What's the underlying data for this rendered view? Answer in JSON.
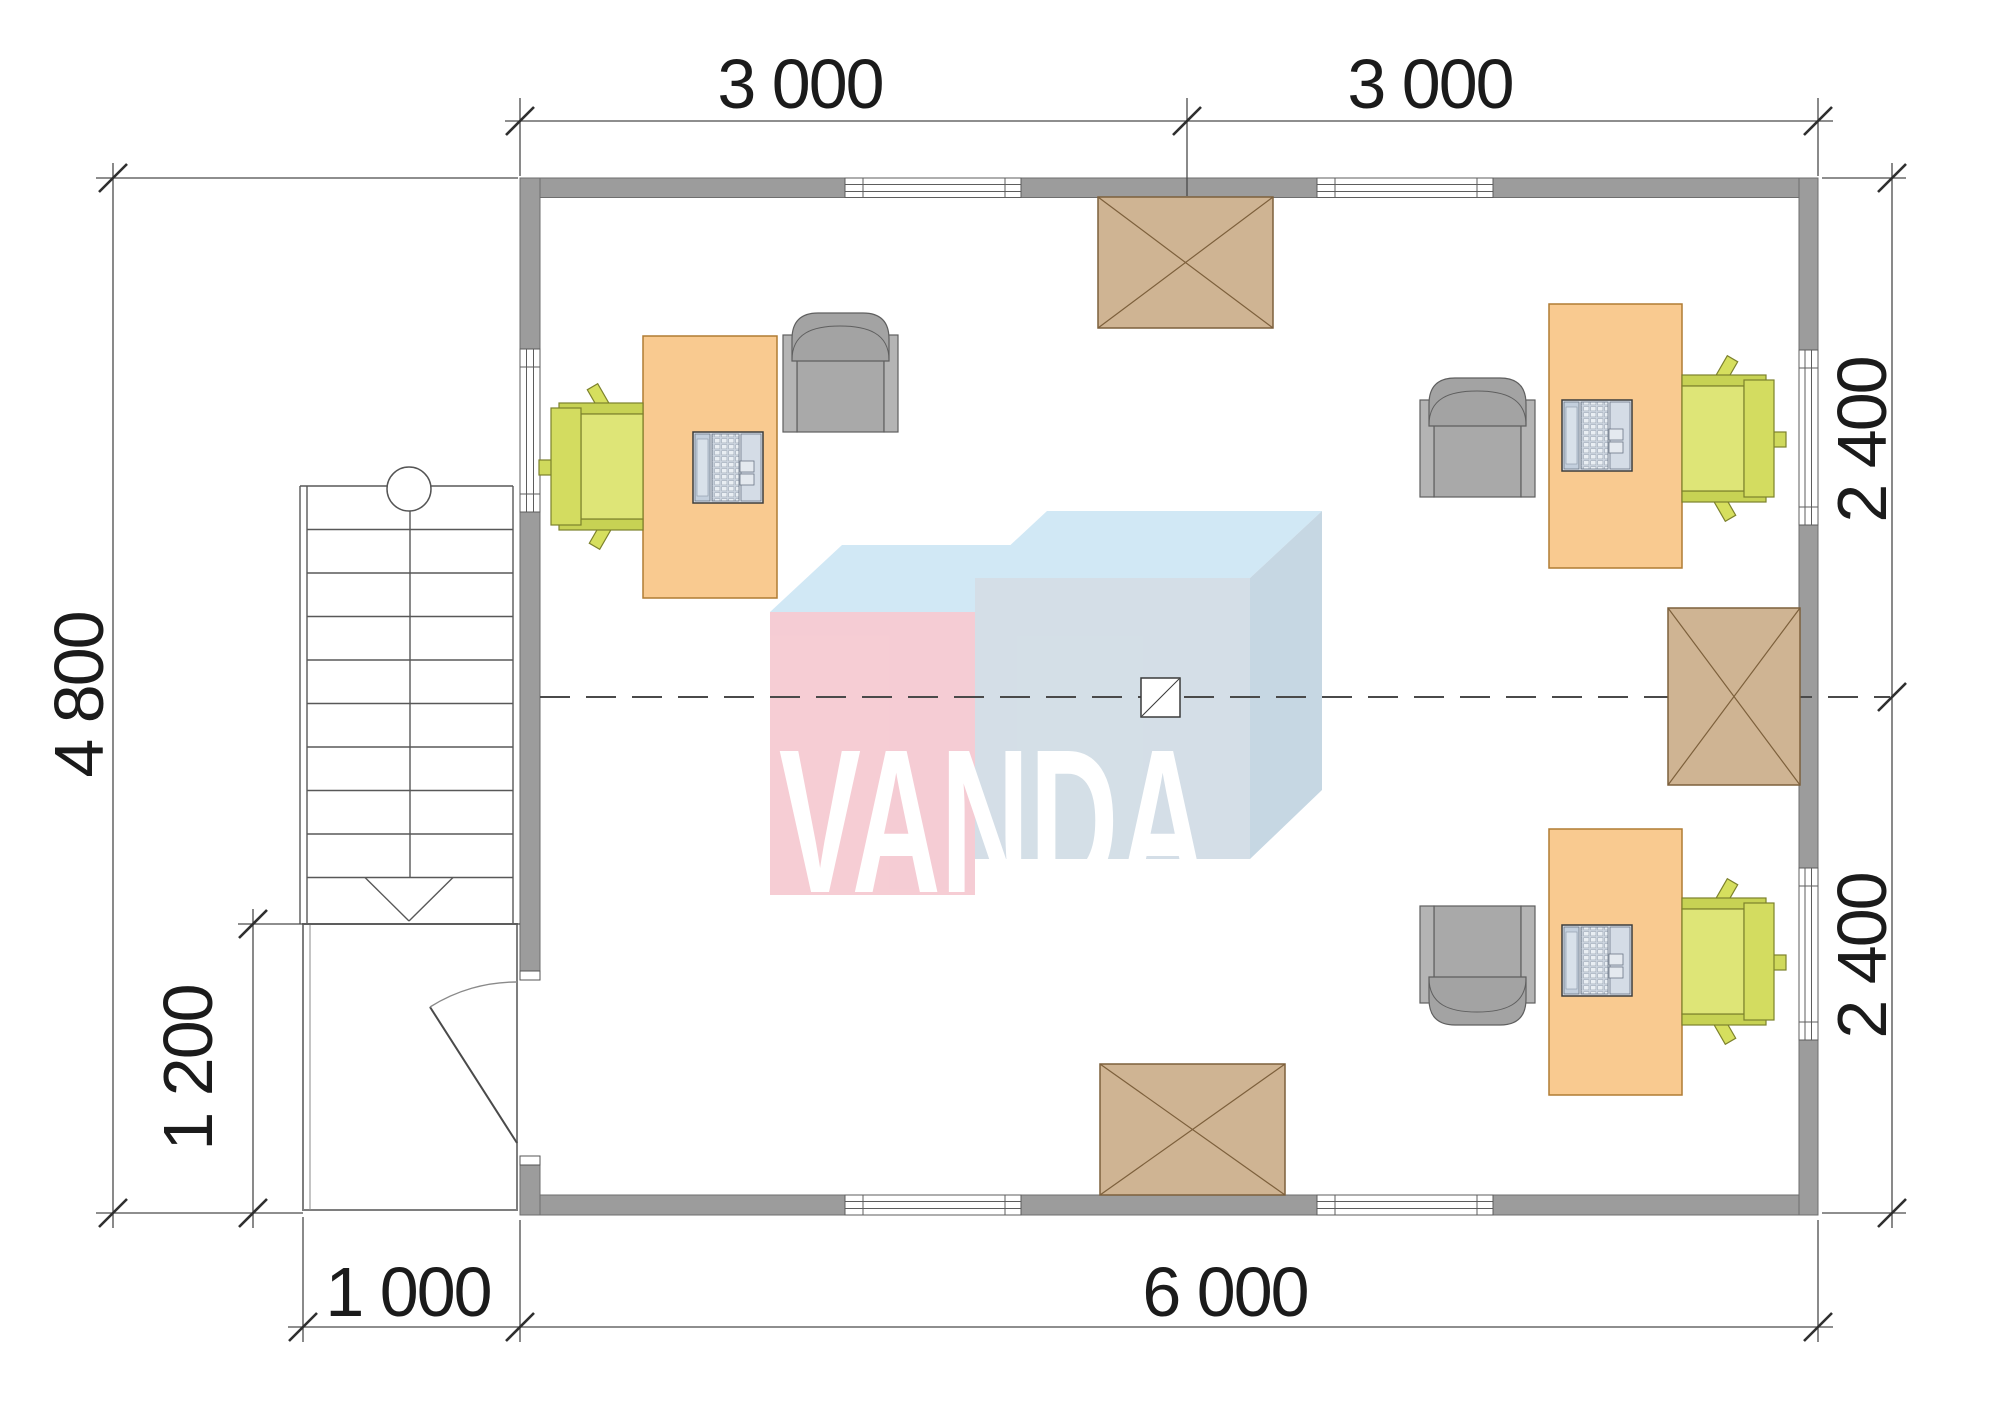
{
  "dimensions": {
    "top_left_span": "3 000",
    "top_right_span": "3 000",
    "left_height": "4 800",
    "porch_height": "1 200",
    "right_upper_span": "2 400",
    "right_lower_span": "2 400",
    "bottom_porch_span": "1 000",
    "bottom_main_span": "6 000"
  },
  "watermark": {
    "text": "VANDA"
  },
  "colors": {
    "wall": "#9c9c9c",
    "desk": "#f9ca90",
    "task_chair": "#dde577",
    "armchair": "#a9a9a9",
    "cabinet": "#cfb493",
    "logo_pink": "#f5cad2",
    "logo_blue_top": "#cfe7f5",
    "logo_blue_front": "#d2dde6",
    "logo_letters": "#ffffff"
  }
}
